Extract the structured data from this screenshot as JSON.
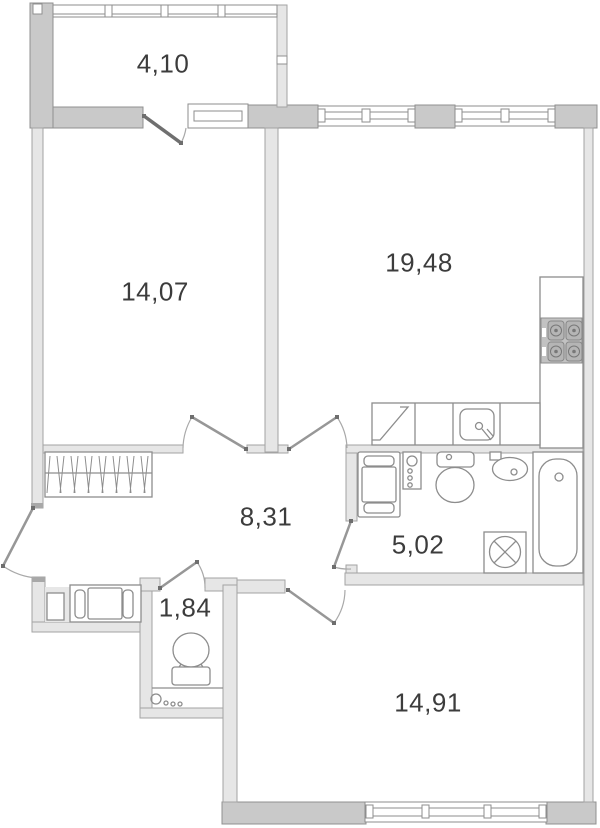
{
  "plan": {
    "type": "apartment-floor-plan",
    "rooms": [
      {
        "id": "balcony",
        "area_label": "4,10"
      },
      {
        "id": "bedroom-1",
        "area_label": "14,07"
      },
      {
        "id": "living-room-kitchen",
        "area_label": "19,48"
      },
      {
        "id": "hallway",
        "area_label": "8,31"
      },
      {
        "id": "bathroom",
        "area_label": "5,02"
      },
      {
        "id": "wc",
        "area_label": "1,84"
      },
      {
        "id": "bedroom-2",
        "area_label": "14,91"
      }
    ],
    "colors": {
      "wall_thick": "#c9c9c9",
      "wall_light": "#e6e6e6",
      "outline": "#8d8d8d",
      "text": "#3c3c3c",
      "background": "#ffffff"
    }
  }
}
